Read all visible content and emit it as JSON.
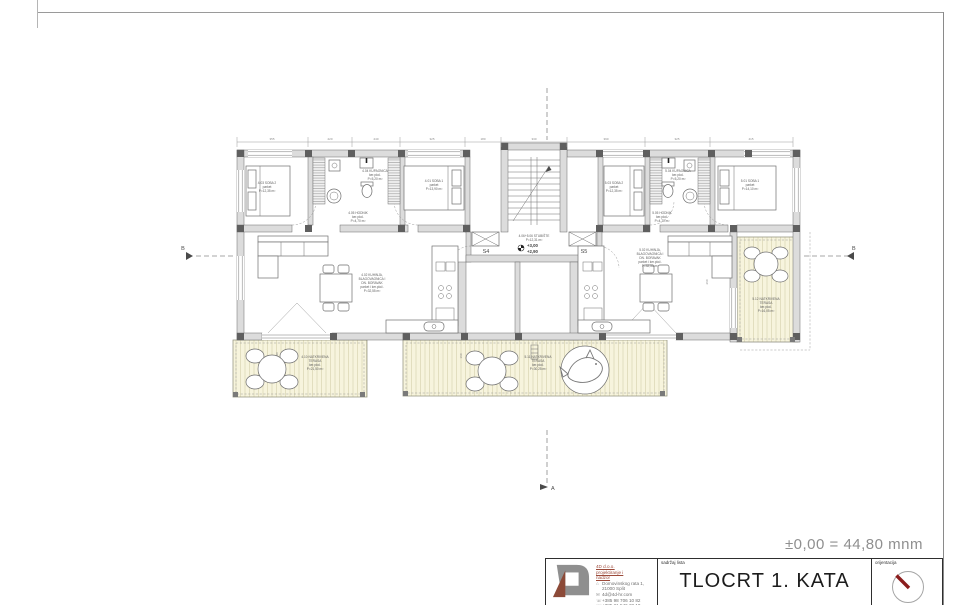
{
  "annotations": {
    "datum_note": "±0,00 = 44,80 mnm",
    "level_upper": "+3,00",
    "level_lower": "+2,90",
    "entry_left": "S4",
    "entry_right": "S5",
    "section_a": "A",
    "section_b_left": "B",
    "section_b_right": "B"
  },
  "dimensions": {
    "top": [
      "355",
      "220",
      "240",
      "325",
      "180",
      "330",
      "390",
      "325",
      "415"
    ],
    "v1": "160",
    "v2": "90",
    "v3": "260"
  },
  "rooms": {
    "a4_soba2": {
      "name": "4.03 SOBA 2",
      "floor": "parket",
      "area": "P=12,35 m²"
    },
    "a4_kupaonica": {
      "name": "4.04 KUPAONICA",
      "floor": "ker.ploč.",
      "area": "P=5,20 m²"
    },
    "a4_hodnik": {
      "name": "4.05 HODNIK",
      "floor": "ker.ploč.",
      "area": "P=4,70 m²"
    },
    "a4_soba1": {
      "name": "4.01 SOBA 1",
      "floor": "parket",
      "area": "P=13,90 m²"
    },
    "a4_dnevni": {
      "name1": "4.02 KUHINJA,",
      "name2": "BLAGOVAONICA I",
      "name3": "DN. BORAVAK",
      "floor": "parket i ker.ploč.",
      "area": "P=32,55 m²"
    },
    "a4_terasa": {
      "name1": "4.10 NATKRIVENA",
      "name2": "TERASA",
      "floor": "ker.ploč.",
      "area": "P=21,50 m²"
    },
    "stubiste": {
      "name": "4.06+5.06 STUBIŠTE",
      "area": "P=12,31 m²"
    },
    "a5_soba2": {
      "name": "5.03 SOBA 2",
      "floor": "parket",
      "area": "P=12,35 m²"
    },
    "a5_kupaonica": {
      "name": "5.04 KUPAONICA",
      "floor": "ker.ploč.",
      "area": "P=5,20 m²"
    },
    "a5_hodnik": {
      "name": "5.05 HODNIK",
      "floor": "ker.ploč.",
      "area": "P=4,70 m²"
    },
    "a5_soba1": {
      "name": "5.01 SOBA 1",
      "floor": "parket",
      "area": "P=14,10 m²"
    },
    "a5_dnevni": {
      "name1": "5.02 KUHINJA,",
      "name2": "BLAGOVAONICA I",
      "name3": "DN. BORAVAK",
      "floor": "parket i ker.ploč.",
      "area": "P=32,55 m²"
    },
    "a5_terasa": {
      "name1": "5.11 NATKRIVENA",
      "name2": "TERASA",
      "floor": "ker.ploč.",
      "area": "P=30,25 m²"
    },
    "a5_terasa2": {
      "name1": "5.12 NATKRIVENA",
      "name2": "TERASA",
      "floor": "ker.ploč.",
      "area": "P=16,05 m²"
    }
  },
  "title_block": {
    "content_label": "sadržaj lista",
    "sheet_title": "TLOCRT 1. KATA",
    "orientation_label": "orijentacija",
    "company": {
      "name": "4D d.o.o.",
      "activity1": "projektiranje i",
      "activity2": "nadzor",
      "address_street": "Domovinskog rata 1,",
      "address_city": "21000 Split",
      "email": "4d@4d-hr.com",
      "phone1": "+385 98 706 10 82",
      "phone2": "+385 21 546 28 10"
    },
    "icons": {
      "address": "⌂",
      "email": "✉",
      "phone": "☏"
    }
  },
  "colors": {
    "terrace_fill": "#f7f4dd",
    "accent_red": "#9c4a3a",
    "needle_red": "#8b1d1d",
    "line_gray": "#6b6b6b"
  }
}
